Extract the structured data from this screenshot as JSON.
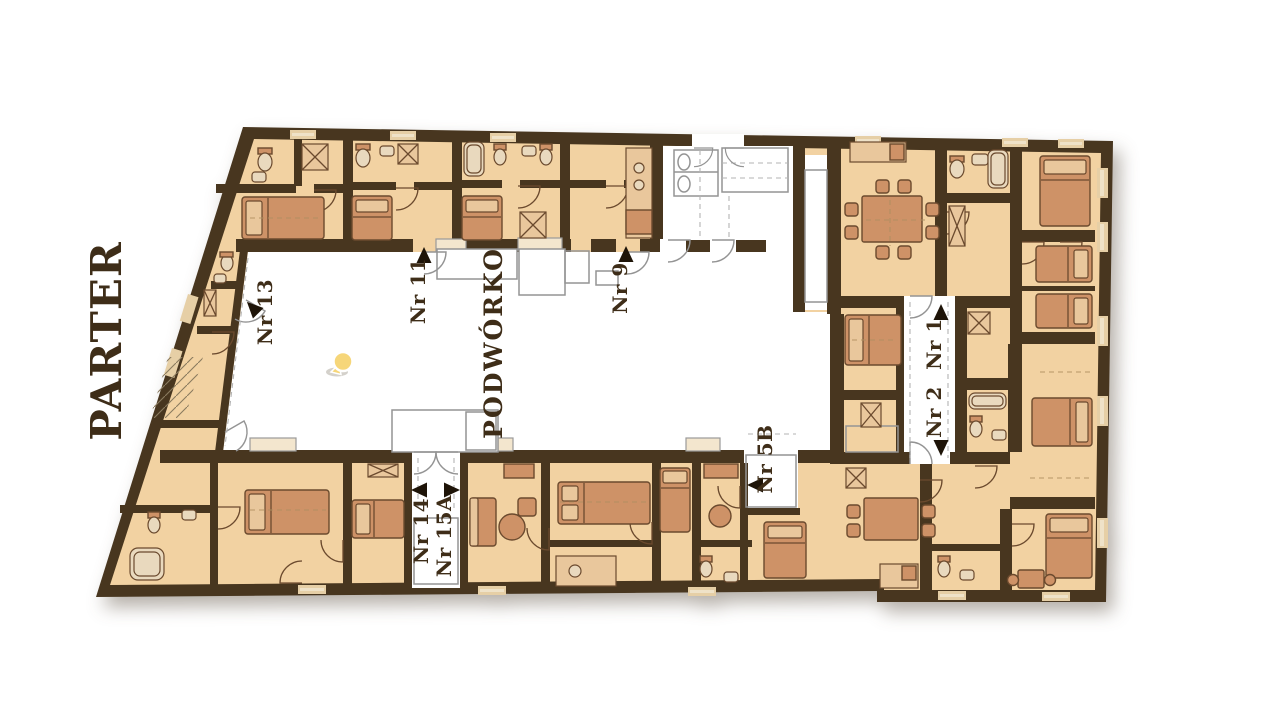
{
  "plan": {
    "floor_label": "PARTER",
    "courtyard_label": "PODWÓRKO",
    "units": [
      {
        "id": "nr13",
        "label": "Nr 13"
      },
      {
        "id": "nr11",
        "label": "Nr 11"
      },
      {
        "id": "nr9",
        "label": "Nr 9"
      },
      {
        "id": "nr1",
        "label": "Nr 1"
      },
      {
        "id": "nr2",
        "label": "Nr 2"
      },
      {
        "id": "nr5b",
        "label": "Nr 5B"
      },
      {
        "id": "nr14",
        "label": "Nr 14"
      },
      {
        "id": "nr15a",
        "label": "Nr 15A"
      }
    ],
    "marker": {
      "name": "location-pin",
      "fill": "#f6d679",
      "stroke": "#ffffff"
    },
    "colors": {
      "wall": "#48361f",
      "room": "#f2d2a2",
      "furniture": "#ce9267",
      "furniture_outline": "#6b4a2e",
      "label_text": "#3e2d18",
      "arrow": "#1e1408",
      "courtyard": "#ffffff",
      "outline_gray": "#949494"
    }
  }
}
